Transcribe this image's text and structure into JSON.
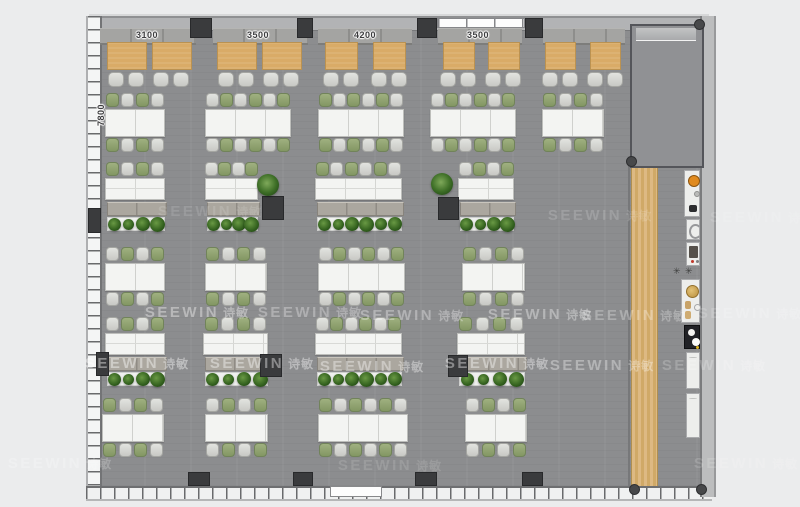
{
  "annotations": {
    "top_dimensions": [
      {
        "text": "3100",
        "x": 147
      },
      {
        "text": "3500",
        "x": 258
      },
      {
        "text": "4200",
        "x": 365
      },
      {
        "text": "3500",
        "x": 478
      }
    ],
    "left_dimension": {
      "text": "7800",
      "x": 101,
      "y": 115
    }
  },
  "watermark": {
    "text": "SEEWIN",
    "cjk": "诗敏",
    "positions": [
      {
        "x": 197,
        "y": 313,
        "o": 0.38
      },
      {
        "x": 310,
        "y": 313,
        "o": 0.3
      },
      {
        "x": 412,
        "y": 316,
        "o": 0.33
      },
      {
        "x": 540,
        "y": 315,
        "o": 0.36
      },
      {
        "x": 634,
        "y": 316,
        "o": 0.28
      },
      {
        "x": 750,
        "y": 314,
        "o": 0.17
      },
      {
        "x": 137,
        "y": 364,
        "o": 0.42
      },
      {
        "x": 262,
        "y": 364,
        "o": 0.4
      },
      {
        "x": 372,
        "y": 367,
        "o": 0.38
      },
      {
        "x": 497,
        "y": 364,
        "o": 0.4
      },
      {
        "x": 602,
        "y": 366,
        "o": 0.34
      },
      {
        "x": 714,
        "y": 366,
        "o": 0.2
      },
      {
        "x": 600,
        "y": 216,
        "o": 0.16
      },
      {
        "x": 762,
        "y": 218,
        "o": 0.13
      },
      {
        "x": 210,
        "y": 212,
        "o": 0.12
      },
      {
        "x": 60,
        "y": 464,
        "o": 0.22
      },
      {
        "x": 390,
        "y": 466,
        "o": 0.13
      },
      {
        "x": 746,
        "y": 464,
        "o": 0.15
      }
    ]
  },
  "colors": {
    "background": "#ebeced",
    "floor": "#8c8d8f",
    "column": "#3a3b3d",
    "booth_table": "#d9ab67",
    "chair_gray": "#d3d4d0",
    "chair_green": "#8da06f",
    "desk_white": "#f3f4f2",
    "cabinet": "#aba79f",
    "planter": "#f0f1ef",
    "wood_strip": "#d7b179",
    "stove_orange": "#e08a1e",
    "watermark": "#ffffff"
  },
  "plan": {
    "backrests": [
      {
        "x": 100,
        "w": 96
      },
      {
        "x": 213,
        "w": 95
      },
      {
        "x": 318,
        "w": 94
      },
      {
        "x": 438,
        "w": 84
      },
      {
        "x": 543,
        "w": 82
      }
    ],
    "booths": [
      {
        "x": 107,
        "w": 38
      },
      {
        "x": 152,
        "w": 38
      },
      {
        "x": 217,
        "w": 38
      },
      {
        "x": 262,
        "w": 38
      },
      {
        "x": 325,
        "w": 31
      },
      {
        "x": 373,
        "w": 31
      },
      {
        "x": 443,
        "w": 30
      },
      {
        "x": 488,
        "w": 30
      },
      {
        "x": 545,
        "w": 29
      },
      {
        "x": 590,
        "w": 29
      }
    ],
    "desk_rows": [
      {
        "y": 93,
        "clusters": [
          {
            "x": 105,
            "w": 60,
            "seats": 4
          },
          {
            "x": 205,
            "w": 86,
            "seats": 6
          },
          {
            "x": 318,
            "w": 86,
            "seats": 6
          },
          {
            "x": 430,
            "w": 86,
            "seats": 6
          },
          {
            "x": 542,
            "w": 62,
            "seats": 4
          }
        ]
      },
      {
        "y": 247,
        "clusters": [
          {
            "x": 105,
            "w": 60,
            "seats": 4
          },
          {
            "x": 205,
            "w": 62,
            "seats": 4
          },
          {
            "x": 318,
            "w": 87,
            "seats": 6
          },
          {
            "x": 462,
            "w": 63,
            "seats": 4
          }
        ]
      },
      {
        "y": 398,
        "clusters": [
          {
            "x": 102,
            "w": 62,
            "seats": 4
          },
          {
            "x": 205,
            "w": 63,
            "seats": 4
          },
          {
            "x": 318,
            "w": 90,
            "seats": 6
          },
          {
            "x": 465,
            "w": 62,
            "seats": 4
          }
        ]
      }
    ],
    "bench_rows": [
      {
        "y": 162,
        "groups": [
          {
            "x": 105,
            "w": 60,
            "seats": 4,
            "plants": 4
          },
          {
            "x": 205,
            "w": 53,
            "seats": 4,
            "plants": 4
          },
          {
            "x": 315,
            "w": 87,
            "seats": 6,
            "plants": 6
          },
          {
            "x": 458,
            "w": 56,
            "seats": 4,
            "plants": 4
          }
        ]
      },
      {
        "y": 317,
        "groups": [
          {
            "x": 105,
            "w": 60,
            "seats": 4,
            "plants": 4
          },
          {
            "x": 203,
            "w": 65,
            "seats": 4,
            "plants": 4
          },
          {
            "x": 315,
            "w": 87,
            "seats": 6,
            "plants": 6
          },
          {
            "x": 457,
            "w": 68,
            "seats": 4,
            "plants": 4
          }
        ]
      }
    ],
    "columns_top": [
      {
        "x": 190,
        "w": 22
      },
      {
        "x": 297,
        "w": 16
      },
      {
        "x": 417,
        "w": 20
      },
      {
        "x": 525,
        "w": 18
      }
    ],
    "columns_bottom": [
      {
        "x": 188,
        "w": 22
      },
      {
        "x": 293,
        "w": 20
      },
      {
        "x": 415,
        "w": 22
      },
      {
        "x": 522,
        "w": 21
      }
    ],
    "columns_interior": [
      {
        "x": 262,
        "y": 196,
        "w": 22,
        "h": 24
      },
      {
        "x": 438,
        "y": 197,
        "w": 21,
        "h": 23
      },
      {
        "x": 88,
        "y": 208,
        "w": 13,
        "h": 25
      },
      {
        "x": 96,
        "y": 352,
        "w": 13,
        "h": 24
      },
      {
        "x": 260,
        "y": 354,
        "w": 22,
        "h": 23
      },
      {
        "x": 448,
        "y": 355,
        "w": 20,
        "h": 22
      }
    ],
    "standalone_plants": [
      {
        "x": 257,
        "y": 174,
        "s": 22
      },
      {
        "x": 431,
        "y": 173,
        "s": 22
      }
    ],
    "corner_dots": [
      {
        "x": 694,
        "y": 19
      },
      {
        "x": 626,
        "y": 156
      },
      {
        "x": 629,
        "y": 484
      },
      {
        "x": 696,
        "y": 484
      }
    ],
    "pantry": [
      {
        "kind": "stove",
        "x": 684,
        "y": 170,
        "w": 16,
        "h": 47
      },
      {
        "kind": "sink",
        "x": 686,
        "y": 219,
        "w": 14,
        "h": 21
      },
      {
        "kind": "machine",
        "x": 686,
        "y": 242,
        "w": 14,
        "h": 24
      },
      {
        "kind": "stool",
        "x": 673,
        "y": 267,
        "w": 9,
        "h": 9
      },
      {
        "kind": "stool",
        "x": 685,
        "y": 267,
        "w": 9,
        "h": 9
      },
      {
        "kind": "bowls",
        "x": 681,
        "y": 279,
        "w": 19,
        "h": 44
      },
      {
        "kind": "fridge",
        "x": 684,
        "y": 325,
        "w": 16,
        "h": 24
      },
      {
        "kind": "cabinet",
        "x": 686,
        "y": 352,
        "w": 14,
        "h": 37
      },
      {
        "kind": "cabinet",
        "x": 686,
        "y": 393,
        "w": 14,
        "h": 45
      }
    ]
  }
}
